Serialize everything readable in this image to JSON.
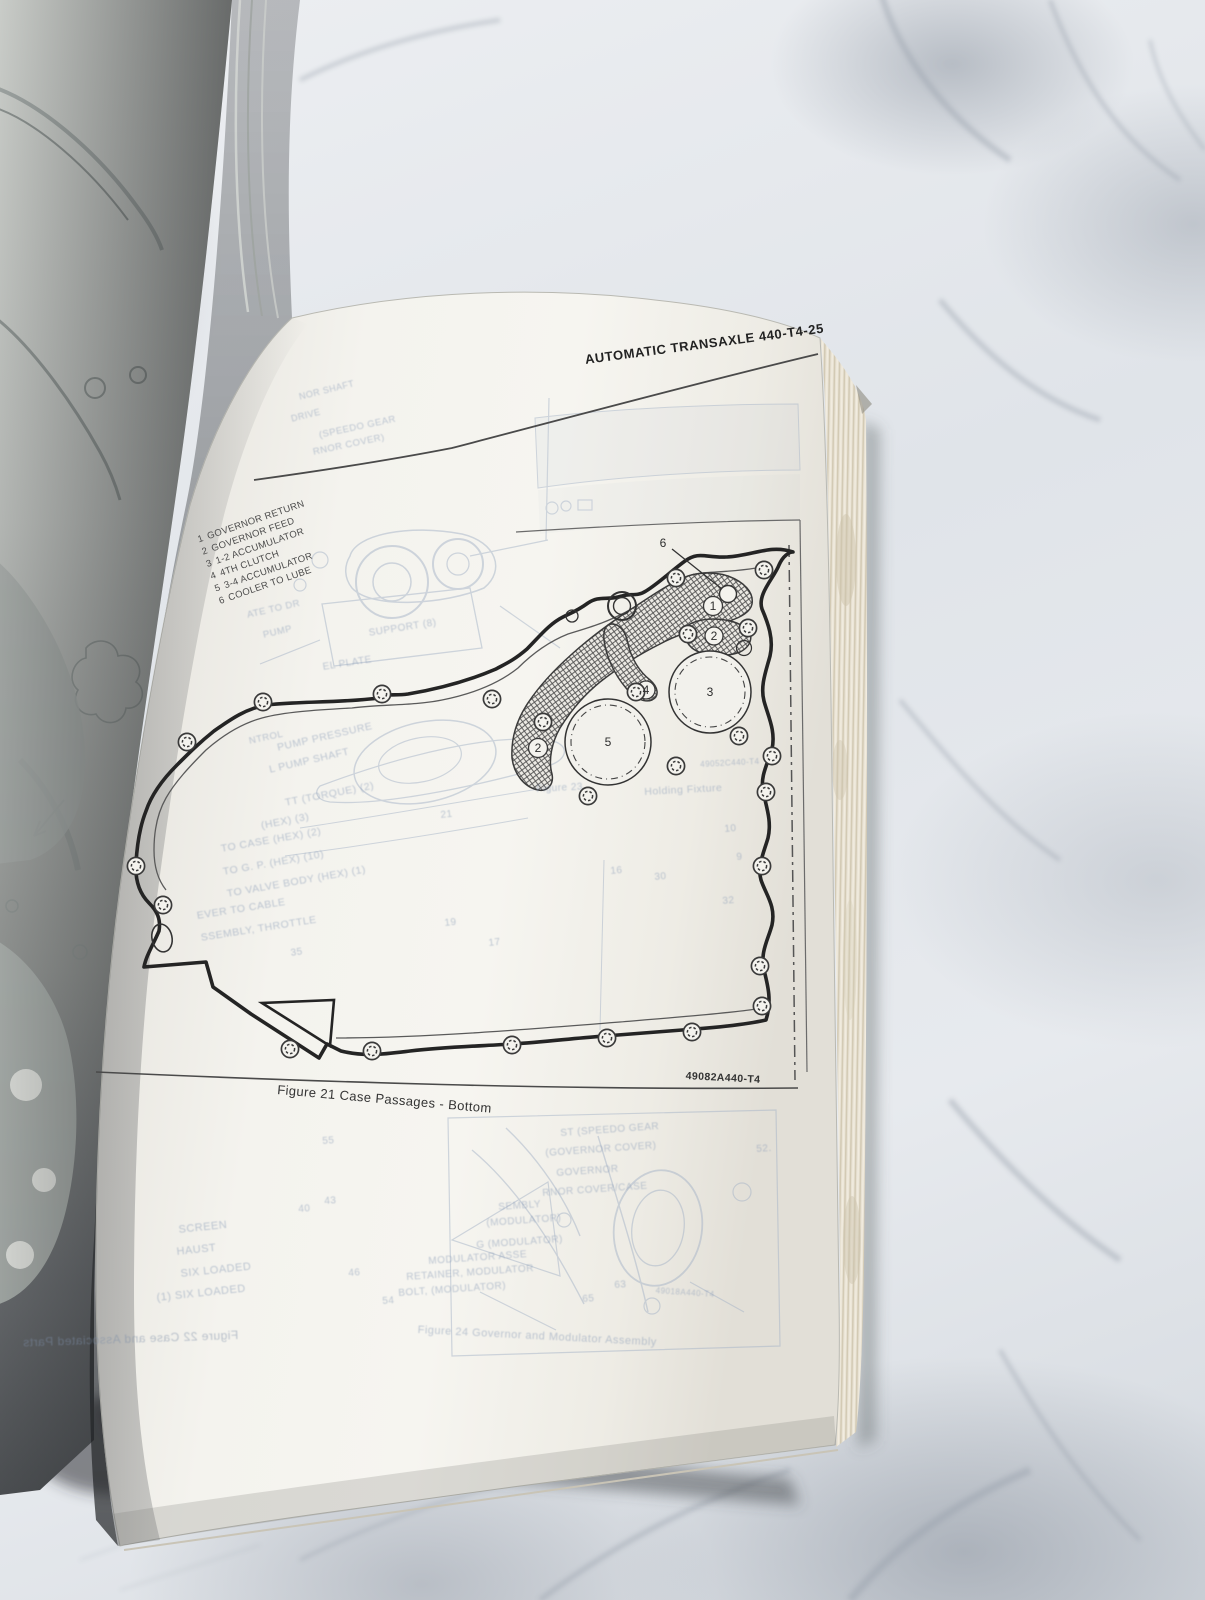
{
  "book": {
    "right_page": {
      "header": "AUTOMATIC TRANSAXLE 440-T4-25",
      "legend": [
        {
          "num": "1",
          "label": "GOVERNOR RETURN"
        },
        {
          "num": "2",
          "label": "GOVERNOR FEED"
        },
        {
          "num": "3",
          "label": "1-2 ACCUMULATOR"
        },
        {
          "num": "4",
          "label": "4TH CLUTCH"
        },
        {
          "num": "5",
          "label": "3-4 ACCUMULATOR"
        },
        {
          "num": "6",
          "label": "COOLER TO LUBE"
        }
      ],
      "figure": {
        "caption": "Figure 21 Case Passages - Bottom",
        "part_code": "49082A440-T4",
        "callouts": [
          {
            "n": "6",
            "x": 663,
            "y": 543
          },
          {
            "n": "1",
            "x": 713,
            "y": 606
          },
          {
            "n": "2",
            "x": 714,
            "y": 636
          },
          {
            "n": "3",
            "x": 710,
            "y": 692
          },
          {
            "n": "4",
            "x": 646,
            "y": 690
          },
          {
            "n": "5",
            "x": 608,
            "y": 742
          },
          {
            "n": "2",
            "x": 538,
            "y": 748
          }
        ]
      },
      "bleed_through": [
        {
          "text": "NOR SHAFT",
          "x": 298,
          "y": 392,
          "rot": -14,
          "size": 9
        },
        {
          "text": "DRIVE",
          "x": 290,
          "y": 414,
          "rot": -14,
          "size": 9
        },
        {
          "text": "(SPEEDO GEAR",
          "x": 318,
          "y": 430,
          "rot": -12,
          "size": 9.5
        },
        {
          "text": "RNOR COVER)",
          "x": 312,
          "y": 447,
          "rot": -12,
          "size": 9.5
        },
        {
          "text": "ATE TO DR",
          "x": 246,
          "y": 610,
          "rot": -13,
          "size": 9.5
        },
        {
          "text": "PUMP",
          "x": 262,
          "y": 630,
          "rot": -13,
          "size": 9.5
        },
        {
          "text": "SUPPORT (8)",
          "x": 368,
          "y": 628,
          "rot": -9,
          "size": 10
        },
        {
          "text": "EL PLATE",
          "x": 322,
          "y": 662,
          "rot": -9,
          "size": 10
        },
        {
          "text": "NTROL",
          "x": 248,
          "y": 736,
          "rot": -12,
          "size": 9.5
        },
        {
          "text": "PUMP PRESSURE",
          "x": 276,
          "y": 742,
          "rot": -13,
          "size": 10.5
        },
        {
          "text": "L PUMP SHAFT",
          "x": 268,
          "y": 764,
          "rot": -13,
          "size": 10.5
        },
        {
          "text": "TT (TORQUE) (2)",
          "x": 284,
          "y": 797,
          "rot": -11,
          "size": 10.5
        },
        {
          "text": "(HEX) (3)",
          "x": 260,
          "y": 820,
          "rot": -11,
          "size": 10.5
        },
        {
          "text": "TO CASE (HEX) (2)",
          "x": 220,
          "y": 843,
          "rot": -10,
          "size": 10.5
        },
        {
          "text": "TO G. P. (HEX) (10)",
          "x": 222,
          "y": 866,
          "rot": -10,
          "size": 10.5
        },
        {
          "text": "TO VALVE BODY (HEX) (1)",
          "x": 226,
          "y": 888,
          "rot": -10,
          "size": 10.5
        },
        {
          "text": "EVER TO CABLE",
          "x": 196,
          "y": 910,
          "rot": -9,
          "size": 10.5
        },
        {
          "text": "SSEMBLY, THROTTLE",
          "x": 200,
          "y": 932,
          "rot": -9,
          "size": 10.5
        },
        {
          "text": "35",
          "x": 290,
          "y": 948,
          "rot": -8,
          "size": 10
        },
        {
          "text": "21",
          "x": 440,
          "y": 810,
          "rot": -6,
          "size": 10
        },
        {
          "text": "19",
          "x": 444,
          "y": 918,
          "rot": -6,
          "size": 10
        },
        {
          "text": "17",
          "x": 488,
          "y": 938,
          "rot": -6,
          "size": 10
        },
        {
          "text": "16",
          "x": 610,
          "y": 866,
          "rot": -5,
          "size": 10
        },
        {
          "text": "30",
          "x": 654,
          "y": 872,
          "rot": -5,
          "size": 10
        },
        {
          "text": "32",
          "x": 722,
          "y": 896,
          "rot": -5,
          "size": 10
        },
        {
          "text": "10",
          "x": 724,
          "y": 824,
          "rot": -5,
          "size": 10
        },
        {
          "text": "9",
          "x": 736,
          "y": 852,
          "rot": -5,
          "size": 10
        },
        {
          "text": "Figure 23",
          "x": 536,
          "y": 784,
          "rot": -3,
          "size": 10
        },
        {
          "text": "Holding Fixture",
          "x": 644,
          "y": 786,
          "rot": -3,
          "size": 10.5
        },
        {
          "text": "49052C440-T4",
          "x": 700,
          "y": 760,
          "rot": -3,
          "size": 8
        },
        {
          "text": "ST (SPEEDO GEAR",
          "x": 560,
          "y": 1128,
          "rot": -4,
          "size": 10
        },
        {
          "text": "(GOVERNOR COVER)",
          "x": 545,
          "y": 1148,
          "rot": -4,
          "size": 10
        },
        {
          "text": "GOVERNOR",
          "x": 556,
          "y": 1168,
          "rot": -4,
          "size": 10
        },
        {
          "text": "RNOR COVER/CASE",
          "x": 542,
          "y": 1188,
          "rot": -4,
          "size": 10
        },
        {
          "text": "SEMBLY",
          "x": 498,
          "y": 1202,
          "rot": -4,
          "size": 10
        },
        {
          "text": "(MODULATOR)",
          "x": 486,
          "y": 1218,
          "rot": -4,
          "size": 10
        },
        {
          "text": "G (MODULATOR)",
          "x": 476,
          "y": 1240,
          "rot": -4,
          "size": 10
        },
        {
          "text": "MODULATOR ASSE",
          "x": 428,
          "y": 1256,
          "rot": -4,
          "size": 10
        },
        {
          "text": "RETAINER, MODULATOR",
          "x": 406,
          "y": 1272,
          "rot": -4,
          "size": 10
        },
        {
          "text": "BOLT, (MODULATOR)",
          "x": 398,
          "y": 1288,
          "rot": -4,
          "size": 10
        },
        {
          "text": "Figure 24 Governor and Modulator Assembly",
          "x": 418,
          "y": 1324,
          "rot": 3,
          "size": 11
        },
        {
          "text": "SCREEN",
          "x": 178,
          "y": 1224,
          "rot": -6,
          "size": 11
        },
        {
          "text": "HAUST",
          "x": 176,
          "y": 1246,
          "rot": -6,
          "size": 11
        },
        {
          "text": "SIX LOADED",
          "x": 180,
          "y": 1268,
          "rot": -6,
          "size": 11
        },
        {
          "text": "(1) SIX LOADED",
          "x": 156,
          "y": 1292,
          "rot": -6,
          "size": 11
        },
        {
          "text": "55",
          "x": 322,
          "y": 1136,
          "rot": -4,
          "size": 10
        },
        {
          "text": "52.",
          "x": 756,
          "y": 1144,
          "rot": -4,
          "size": 10
        },
        {
          "text": "43",
          "x": 324,
          "y": 1196,
          "rot": -4,
          "size": 10
        },
        {
          "text": "40",
          "x": 298,
          "y": 1204,
          "rot": -4,
          "size": 10
        },
        {
          "text": "46",
          "x": 348,
          "y": 1268,
          "rot": -4,
          "size": 10
        },
        {
          "text": "54",
          "x": 382,
          "y": 1296,
          "rot": -4,
          "size": 10
        },
        {
          "text": "65",
          "x": 582,
          "y": 1294,
          "rot": -4,
          "size": 10
        },
        {
          "text": "63",
          "x": 614,
          "y": 1280,
          "rot": -4,
          "size": 10
        },
        {
          "text": "49018A440-T4",
          "x": 656,
          "y": 1286,
          "rot": 4,
          "size": 8
        },
        {
          "text": "Figure 22 Case and Associated Parts",
          "x": 238,
          "y": 1328,
          "rot": -2,
          "size": 12,
          "mirror": true
        }
      ]
    }
  },
  "diagram": {
    "bolt_positions": [
      [
        263,
        702
      ],
      [
        382,
        694
      ],
      [
        492,
        699
      ],
      [
        187,
        742
      ],
      [
        136,
        866
      ],
      [
        163,
        905
      ],
      [
        290,
        1049
      ],
      [
        372,
        1051
      ],
      [
        512,
        1045
      ],
      [
        607,
        1038
      ],
      [
        692,
        1032
      ],
      [
        762,
        1006
      ],
      [
        760,
        966
      ],
      [
        762,
        866
      ],
      [
        766,
        792
      ],
      [
        748,
        628
      ],
      [
        764,
        570
      ],
      [
        676,
        578
      ],
      [
        688,
        634
      ],
      [
        636,
        692
      ],
      [
        543,
        722
      ],
      [
        676,
        766
      ],
      [
        739,
        736
      ],
      [
        772,
        756
      ],
      [
        588,
        796
      ]
    ]
  }
}
